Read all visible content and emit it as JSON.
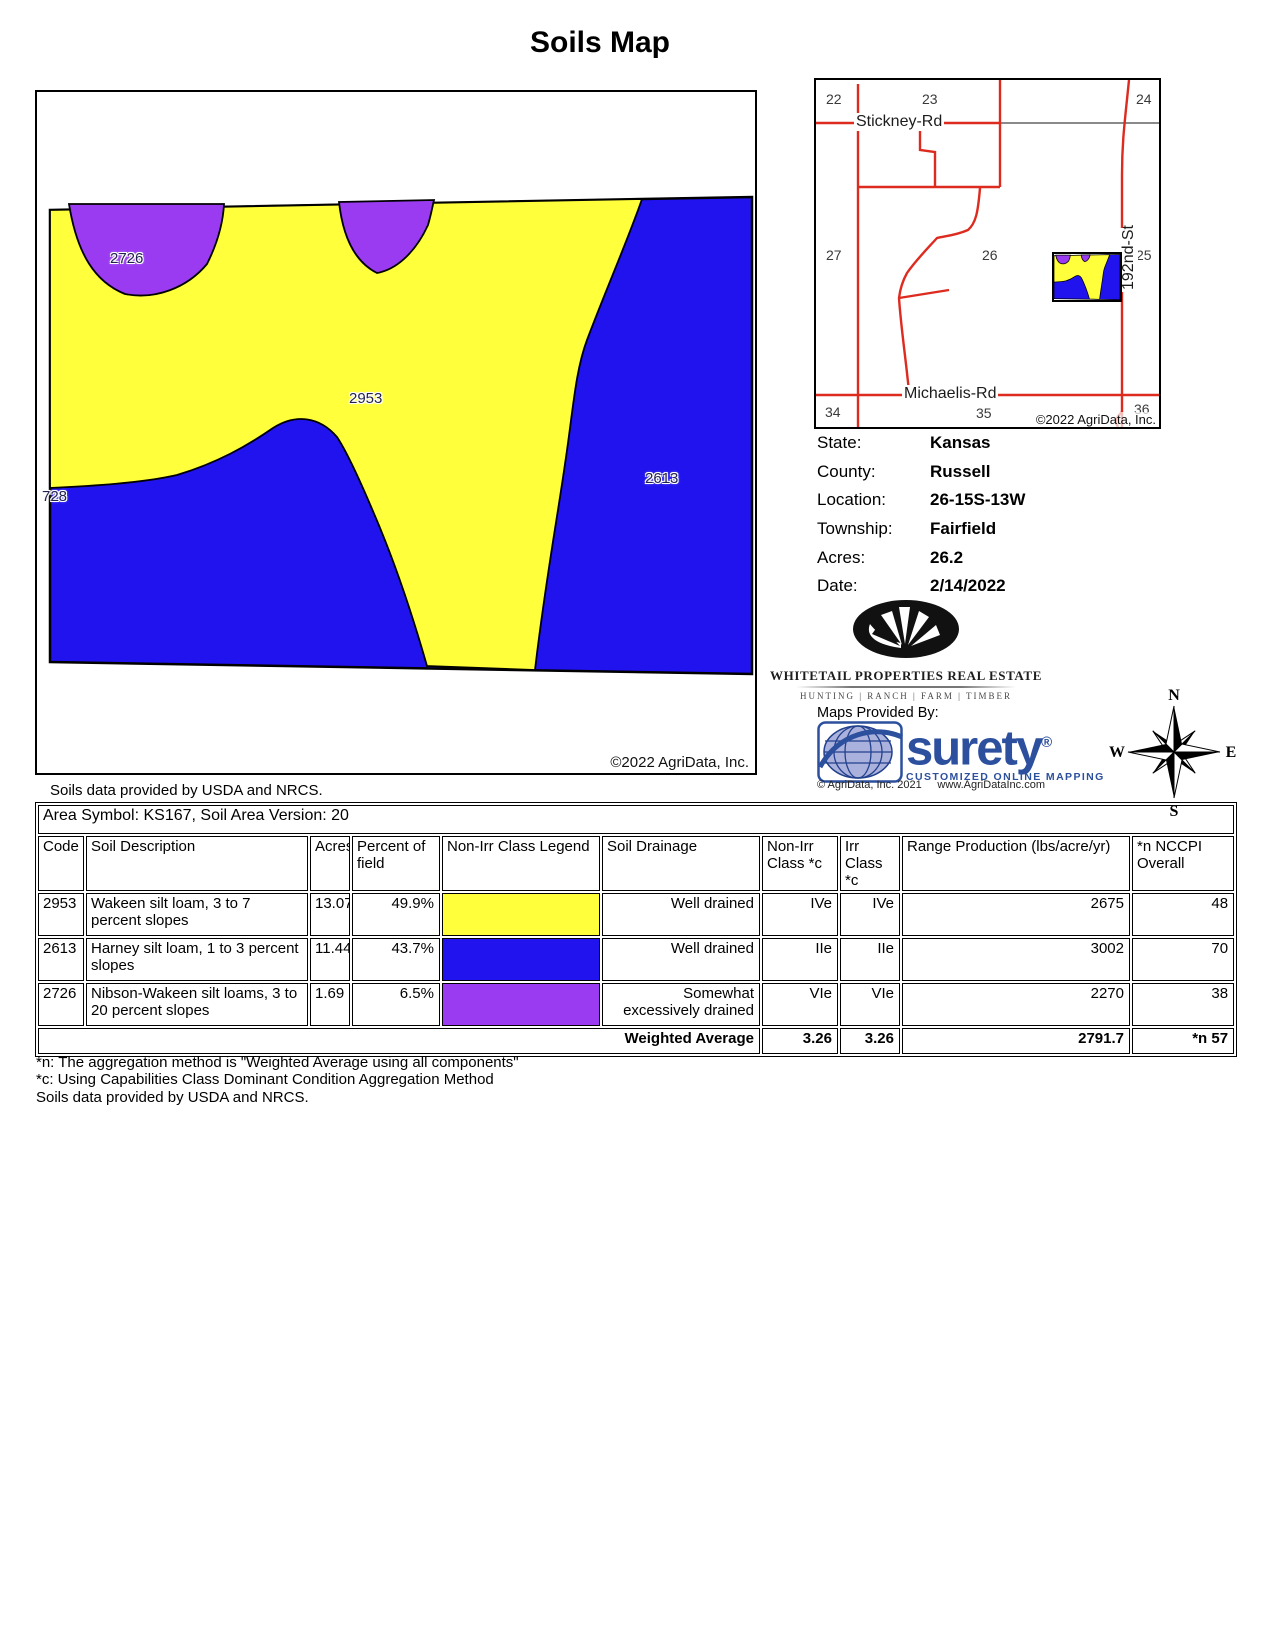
{
  "title": "Soils Map",
  "colors": {
    "yellow": "#FFFF3B",
    "blue": "#2013EE",
    "purple": "#9A3BF2",
    "roadred": "#DD2B20",
    "roadgray": "#8a8a8a",
    "brandblue": "#2C4F9E",
    "globefill": "#aab1dd"
  },
  "map": {
    "labels": {
      "r2726": "2726",
      "r2953": "2953",
      "r2613": "2613",
      "r728": "728"
    },
    "copyright": "©2022 AgriData, Inc.",
    "caption": "Soils data provided by USDA and NRCS."
  },
  "inset": {
    "sections": [
      "22",
      "23",
      "24",
      "27",
      "26",
      "25",
      "34",
      "35",
      "36"
    ],
    "roads": {
      "stickney": "Stickney-Rd",
      "michaelis": "Michaelis-Rd",
      "street192": "192nd-St"
    },
    "copyright": "©2022 AgriData, Inc."
  },
  "info": {
    "rows": [
      {
        "label": "State:",
        "value": "Kansas"
      },
      {
        "label": "County:",
        "value": "Russell"
      },
      {
        "label": "Location:",
        "value": "26-15S-13W"
      },
      {
        "label": "Township:",
        "value": "Fairfield"
      },
      {
        "label": "Acres:",
        "value": "26.2"
      },
      {
        "label": "Date:",
        "value": "2/14/2022"
      }
    ]
  },
  "branding": {
    "whitetail_name": "WHITETAIL PROPERTIES REAL ESTATE",
    "whitetail_tagline": "HUNTING  |  RANCH  |  FARM  |  TIMBER",
    "maps_provided": "Maps Provided By:",
    "surety_word": "surety",
    "surety_reg": "®",
    "surety_sub": "CUSTOMIZED ONLINE MAPPING",
    "surety_copyright": "© AgriData, Inc. 2021",
    "surety_url": "www.AgriDataInc.com"
  },
  "compass": {
    "n": "N",
    "e": "E",
    "s": "S",
    "w": "W"
  },
  "table": {
    "area_symbol": "Area Symbol: KS167, Soil Area Version: 20",
    "headers": [
      "Code",
      "Soil Description",
      "Acres",
      "Percent of field",
      "Non-Irr Class Legend",
      "Soil Drainage",
      "Non-Irr Class *c",
      "Irr Class *c",
      "Range Production (lbs/acre/yr)",
      "*n NCCPI Overall"
    ],
    "rows": [
      {
        "code": "2953",
        "description": "Wakeen silt loam, 3 to 7 percent slopes",
        "acres": "13.07",
        "percent": "49.9%",
        "legend": "#FFFF3B",
        "drainage": "Well drained",
        "non_irr": "IVe",
        "irr": "IVe",
        "range": "2675",
        "nccpi": "48"
      },
      {
        "code": "2613",
        "description": "Harney silt loam, 1 to 3 percent slopes",
        "acres": "11.44",
        "percent": "43.7%",
        "legend": "#2013EE",
        "drainage": "Well drained",
        "non_irr": "IIe",
        "irr": "IIe",
        "range": "3002",
        "nccpi": "70"
      },
      {
        "code": "2726",
        "description": "Nibson-Wakeen silt loams, 3 to 20 percent slopes",
        "acres": "1.69",
        "percent": "6.5%",
        "legend": "#9A3BF2",
        "drainage": "Somewhat excessively drained",
        "non_irr": "VIe",
        "irr": "VIe",
        "range": "2270",
        "nccpi": "38"
      }
    ],
    "weighted": {
      "label": "Weighted Average",
      "non_irr": "3.26",
      "irr": "3.26",
      "range": "2791.7",
      "nccpi": "*n 57"
    }
  },
  "footnotes": [
    "*n: The aggregation method is \"Weighted Average using all components\"",
    "*c: Using Capabilities Class Dominant Condition Aggregation Method",
    "Soils data provided by USDA and NRCS."
  ]
}
